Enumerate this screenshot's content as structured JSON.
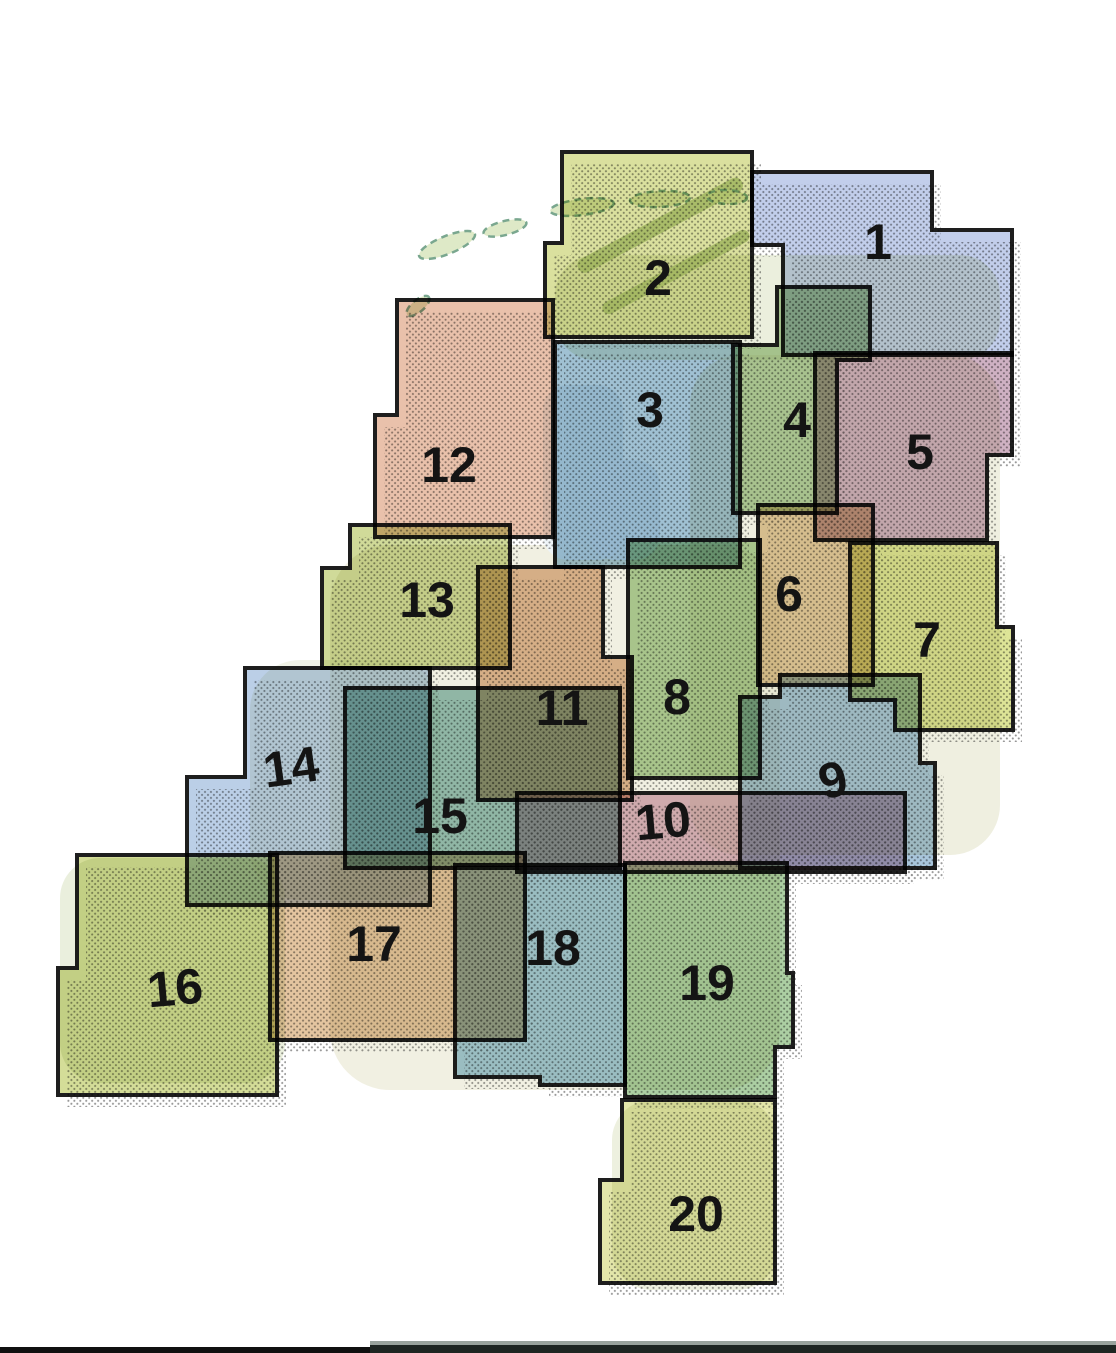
{
  "canvas": {
    "width": 1116,
    "height": 1353,
    "background": "#ffffff"
  },
  "styles": {
    "tile_fill_opacity": 0.85,
    "stroke_color": "#1e1e1e",
    "stroke_width": 4,
    "label_color": "#141414",
    "label_font_size": 50,
    "shadow_offset_x": 9,
    "shadow_offset_y": 12,
    "shadow_opacity": 0.45,
    "shadow_dot_color": "#1a1a1a",
    "island_fill": "#d3e2b4",
    "island_stroke": "#7aa78f",
    "dune_band_color": "#b8cc93"
  },
  "basemap": {
    "land_patches": [
      {
        "x": 555,
        "y": 255,
        "w": 445,
        "h": 105,
        "rx": 40,
        "color": "#dde5c6",
        "opacity": 0.6
      },
      {
        "x": 690,
        "y": 355,
        "w": 310,
        "h": 500,
        "rx": 50,
        "color": "#e0e0c2",
        "opacity": 0.5
      },
      {
        "x": 330,
        "y": 545,
        "w": 450,
        "h": 545,
        "rx": 60,
        "color": "#e4e1c6",
        "opacity": 0.5
      },
      {
        "x": 60,
        "y": 858,
        "w": 225,
        "h": 225,
        "rx": 40,
        "color": "#dce5c7",
        "opacity": 0.6
      },
      {
        "x": 612,
        "y": 1100,
        "w": 165,
        "h": 190,
        "rx": 40,
        "color": "#e1e6c9",
        "opacity": 0.6
      },
      {
        "x": 250,
        "y": 660,
        "w": 190,
        "h": 240,
        "rx": 50,
        "color": "#dfe4ca",
        "opacity": 0.45
      }
    ],
    "water_patches": [
      {
        "x": 543,
        "y": 385,
        "w": 80,
        "h": 175,
        "rx": 25,
        "color": "#edf3f8",
        "opacity": 0.95
      },
      {
        "x": 590,
        "y": 460,
        "w": 70,
        "h": 100,
        "rx": 25,
        "color": "#eef4f9",
        "opacity": 0.9
      }
    ],
    "dune_bands": [
      {
        "x": 575,
        "y": 262,
        "w": 185,
        "h": 15,
        "rotate": -28
      },
      {
        "x": 600,
        "y": 305,
        "w": 165,
        "h": 13,
        "rotate": -28
      }
    ],
    "islands": [
      {
        "cx": 447,
        "cy": 245,
        "rx": 30,
        "ry": 9,
        "rotate": -22
      },
      {
        "cx": 505,
        "cy": 228,
        "rx": 22,
        "ry": 7,
        "rotate": -14
      },
      {
        "cx": 582,
        "cy": 207,
        "rx": 32,
        "ry": 8,
        "rotate": -7
      },
      {
        "cx": 660,
        "cy": 199,
        "rx": 30,
        "ry": 8,
        "rotate": -3
      },
      {
        "cx": 727,
        "cy": 197,
        "rx": 20,
        "ry": 7,
        "rotate": 2
      },
      {
        "cx": 418,
        "cy": 306,
        "rx": 14,
        "ry": 6,
        "rotate": -40
      }
    ]
  },
  "tiles": [
    {
      "number": "1",
      "color": "#b7c5e7",
      "points": [
        [
          752,
          172
        ],
        [
          932,
          172
        ],
        [
          932,
          230
        ],
        [
          1012,
          230
        ],
        [
          1012,
          355
        ],
        [
          783,
          355
        ],
        [
          783,
          245
        ],
        [
          752,
          245
        ]
      ],
      "label": {
        "x": 878,
        "y": 242,
        "rotate": 0
      }
    },
    {
      "number": "2",
      "color": "#d3da8d",
      "points": [
        [
          562,
          152
        ],
        [
          752,
          152
        ],
        [
          752,
          337
        ],
        [
          545,
          337
        ],
        [
          545,
          243
        ],
        [
          562,
          243
        ]
      ],
      "label": {
        "x": 658,
        "y": 278,
        "rotate": 0
      }
    },
    {
      "number": "3",
      "color": "#8fb6cb",
      "points": [
        [
          555,
          342
        ],
        [
          740,
          342
        ],
        [
          740,
          567
        ],
        [
          555,
          567
        ]
      ],
      "label": {
        "x": 650,
        "y": 410,
        "rotate": 0
      }
    },
    {
      "number": "4",
      "color": "#a6c792",
      "points": [
        [
          777,
          287
        ],
        [
          870,
          287
        ],
        [
          870,
          360
        ],
        [
          837,
          360
        ],
        [
          837,
          513
        ],
        [
          733,
          513
        ],
        [
          733,
          345
        ],
        [
          777,
          345
        ]
      ],
      "label": {
        "x": 797,
        "y": 420,
        "rotate": 0
      }
    },
    {
      "number": "5",
      "color": "#c7a3b9",
      "points": [
        [
          815,
          353
        ],
        [
          1012,
          353
        ],
        [
          1012,
          455
        ],
        [
          987,
          455
        ],
        [
          987,
          540
        ],
        [
          815,
          540
        ]
      ],
      "label": {
        "x": 920,
        "y": 452,
        "rotate": 0
      }
    },
    {
      "number": "6",
      "color": "#dfc190",
      "points": [
        [
          758,
          505
        ],
        [
          873,
          505
        ],
        [
          873,
          685
        ],
        [
          758,
          685
        ]
      ],
      "label": {
        "x": 789,
        "y": 594,
        "rotate": 0
      }
    },
    {
      "number": "7",
      "color": "#d7df85",
      "points": [
        [
          850,
          543
        ],
        [
          997,
          543
        ],
        [
          997,
          627
        ],
        [
          1013,
          627
        ],
        [
          1013,
          730
        ],
        [
          895,
          730
        ],
        [
          895,
          700
        ],
        [
          850,
          700
        ]
      ],
      "label": {
        "x": 927,
        "y": 640,
        "rotate": 0
      }
    },
    {
      "number": "8",
      "color": "#a5c98c",
      "points": [
        [
          628,
          540
        ],
        [
          760,
          540
        ],
        [
          760,
          778
        ],
        [
          628,
          778
        ]
      ],
      "label": {
        "x": 677,
        "y": 697,
        "rotate": 0
      }
    },
    {
      "number": "9",
      "color": "#9abcd6",
      "points": [
        [
          740,
          697
        ],
        [
          780,
          697
        ],
        [
          780,
          675
        ],
        [
          920,
          675
        ],
        [
          920,
          763
        ],
        [
          935,
          763
        ],
        [
          935,
          868
        ],
        [
          740,
          868
        ]
      ],
      "label": {
        "x": 833,
        "y": 780,
        "rotate": -14
      }
    },
    {
      "number": "10",
      "color": "#d5a8b8",
      "points": [
        [
          517,
          793
        ],
        [
          905,
          793
        ],
        [
          905,
          872
        ],
        [
          517,
          872
        ]
      ],
      "label": {
        "x": 663,
        "y": 821,
        "rotate": -5
      }
    },
    {
      "number": "11",
      "color": "#ddad85",
      "points": [
        [
          478,
          567
        ],
        [
          603,
          567
        ],
        [
          603,
          657
        ],
        [
          632,
          657
        ],
        [
          632,
          800
        ],
        [
          478,
          800
        ]
      ],
      "label": {
        "x": 562,
        "y": 708,
        "rotate": 0
      }
    },
    {
      "number": "12",
      "color": "#e5b69c",
      "points": [
        [
          397,
          300
        ],
        [
          553,
          300
        ],
        [
          553,
          537
        ],
        [
          375,
          537
        ],
        [
          375,
          415
        ],
        [
          397,
          415
        ]
      ],
      "label": {
        "x": 449,
        "y": 465,
        "rotate": 0
      }
    },
    {
      "number": "13",
      "color": "#c8d387",
      "points": [
        [
          350,
          525
        ],
        [
          510,
          525
        ],
        [
          510,
          668
        ],
        [
          322,
          668
        ],
        [
          322,
          568
        ],
        [
          350,
          568
        ]
      ],
      "label": {
        "x": 427,
        "y": 600,
        "rotate": 0
      }
    },
    {
      "number": "14",
      "color": "#afc7e3",
      "points": [
        [
          245,
          668
        ],
        [
          430,
          668
        ],
        [
          430,
          905
        ],
        [
          187,
          905
        ],
        [
          187,
          777
        ],
        [
          245,
          777
        ]
      ],
      "label": {
        "x": 291,
        "y": 767,
        "rotate": -8
      }
    },
    {
      "number": "15",
      "color": "#86b7ae",
      "points": [
        [
          345,
          688
        ],
        [
          620,
          688
        ],
        [
          620,
          868
        ],
        [
          345,
          868
        ]
      ],
      "label": {
        "x": 440,
        "y": 816,
        "rotate": 0
      }
    },
    {
      "number": "16",
      "color": "#cdd786",
      "points": [
        [
          77,
          855
        ],
        [
          277,
          855
        ],
        [
          277,
          1095
        ],
        [
          58,
          1095
        ],
        [
          58,
          968
        ],
        [
          77,
          968
        ]
      ],
      "label": {
        "x": 175,
        "y": 988,
        "rotate": -5
      }
    },
    {
      "number": "17",
      "color": "#dfbb8f",
      "points": [
        [
          270,
          853
        ],
        [
          525,
          853
        ],
        [
          525,
          1040
        ],
        [
          270,
          1040
        ]
      ],
      "label": {
        "x": 374,
        "y": 944,
        "rotate": 0
      }
    },
    {
      "number": "18",
      "color": "#93bfd3",
      "points": [
        [
          455,
          865
        ],
        [
          625,
          865
        ],
        [
          625,
          1085
        ],
        [
          540,
          1085
        ],
        [
          540,
          1077
        ],
        [
          455,
          1077
        ]
      ],
      "label": {
        "x": 553,
        "y": 948,
        "rotate": 0
      }
    },
    {
      "number": "19",
      "color": "#9dc793",
      "points": [
        [
          625,
          863
        ],
        [
          787,
          863
        ],
        [
          787,
          973
        ],
        [
          793,
          973
        ],
        [
          793,
          1047
        ],
        [
          775,
          1047
        ],
        [
          775,
          1097
        ],
        [
          625,
          1097
        ]
      ],
      "label": {
        "x": 707,
        "y": 983,
        "rotate": 0
      }
    },
    {
      "number": "20",
      "color": "#dee29b",
      "points": [
        [
          622,
          1100
        ],
        [
          775,
          1100
        ],
        [
          775,
          1283
        ],
        [
          600,
          1283
        ],
        [
          600,
          1180
        ],
        [
          622,
          1180
        ]
      ],
      "label": {
        "x": 696,
        "y": 1214,
        "rotate": 0
      }
    }
  ],
  "footer": {
    "bars": [
      {
        "x": 0,
        "y": 1347,
        "w": 1116,
        "h": 6,
        "color": "#101010"
      },
      {
        "x": 370,
        "y": 1341,
        "w": 746,
        "h": 12,
        "color": "#1e2622"
      },
      {
        "x": 370,
        "y": 1341,
        "w": 746,
        "h": 4,
        "color": "#99a39d"
      }
    ]
  }
}
